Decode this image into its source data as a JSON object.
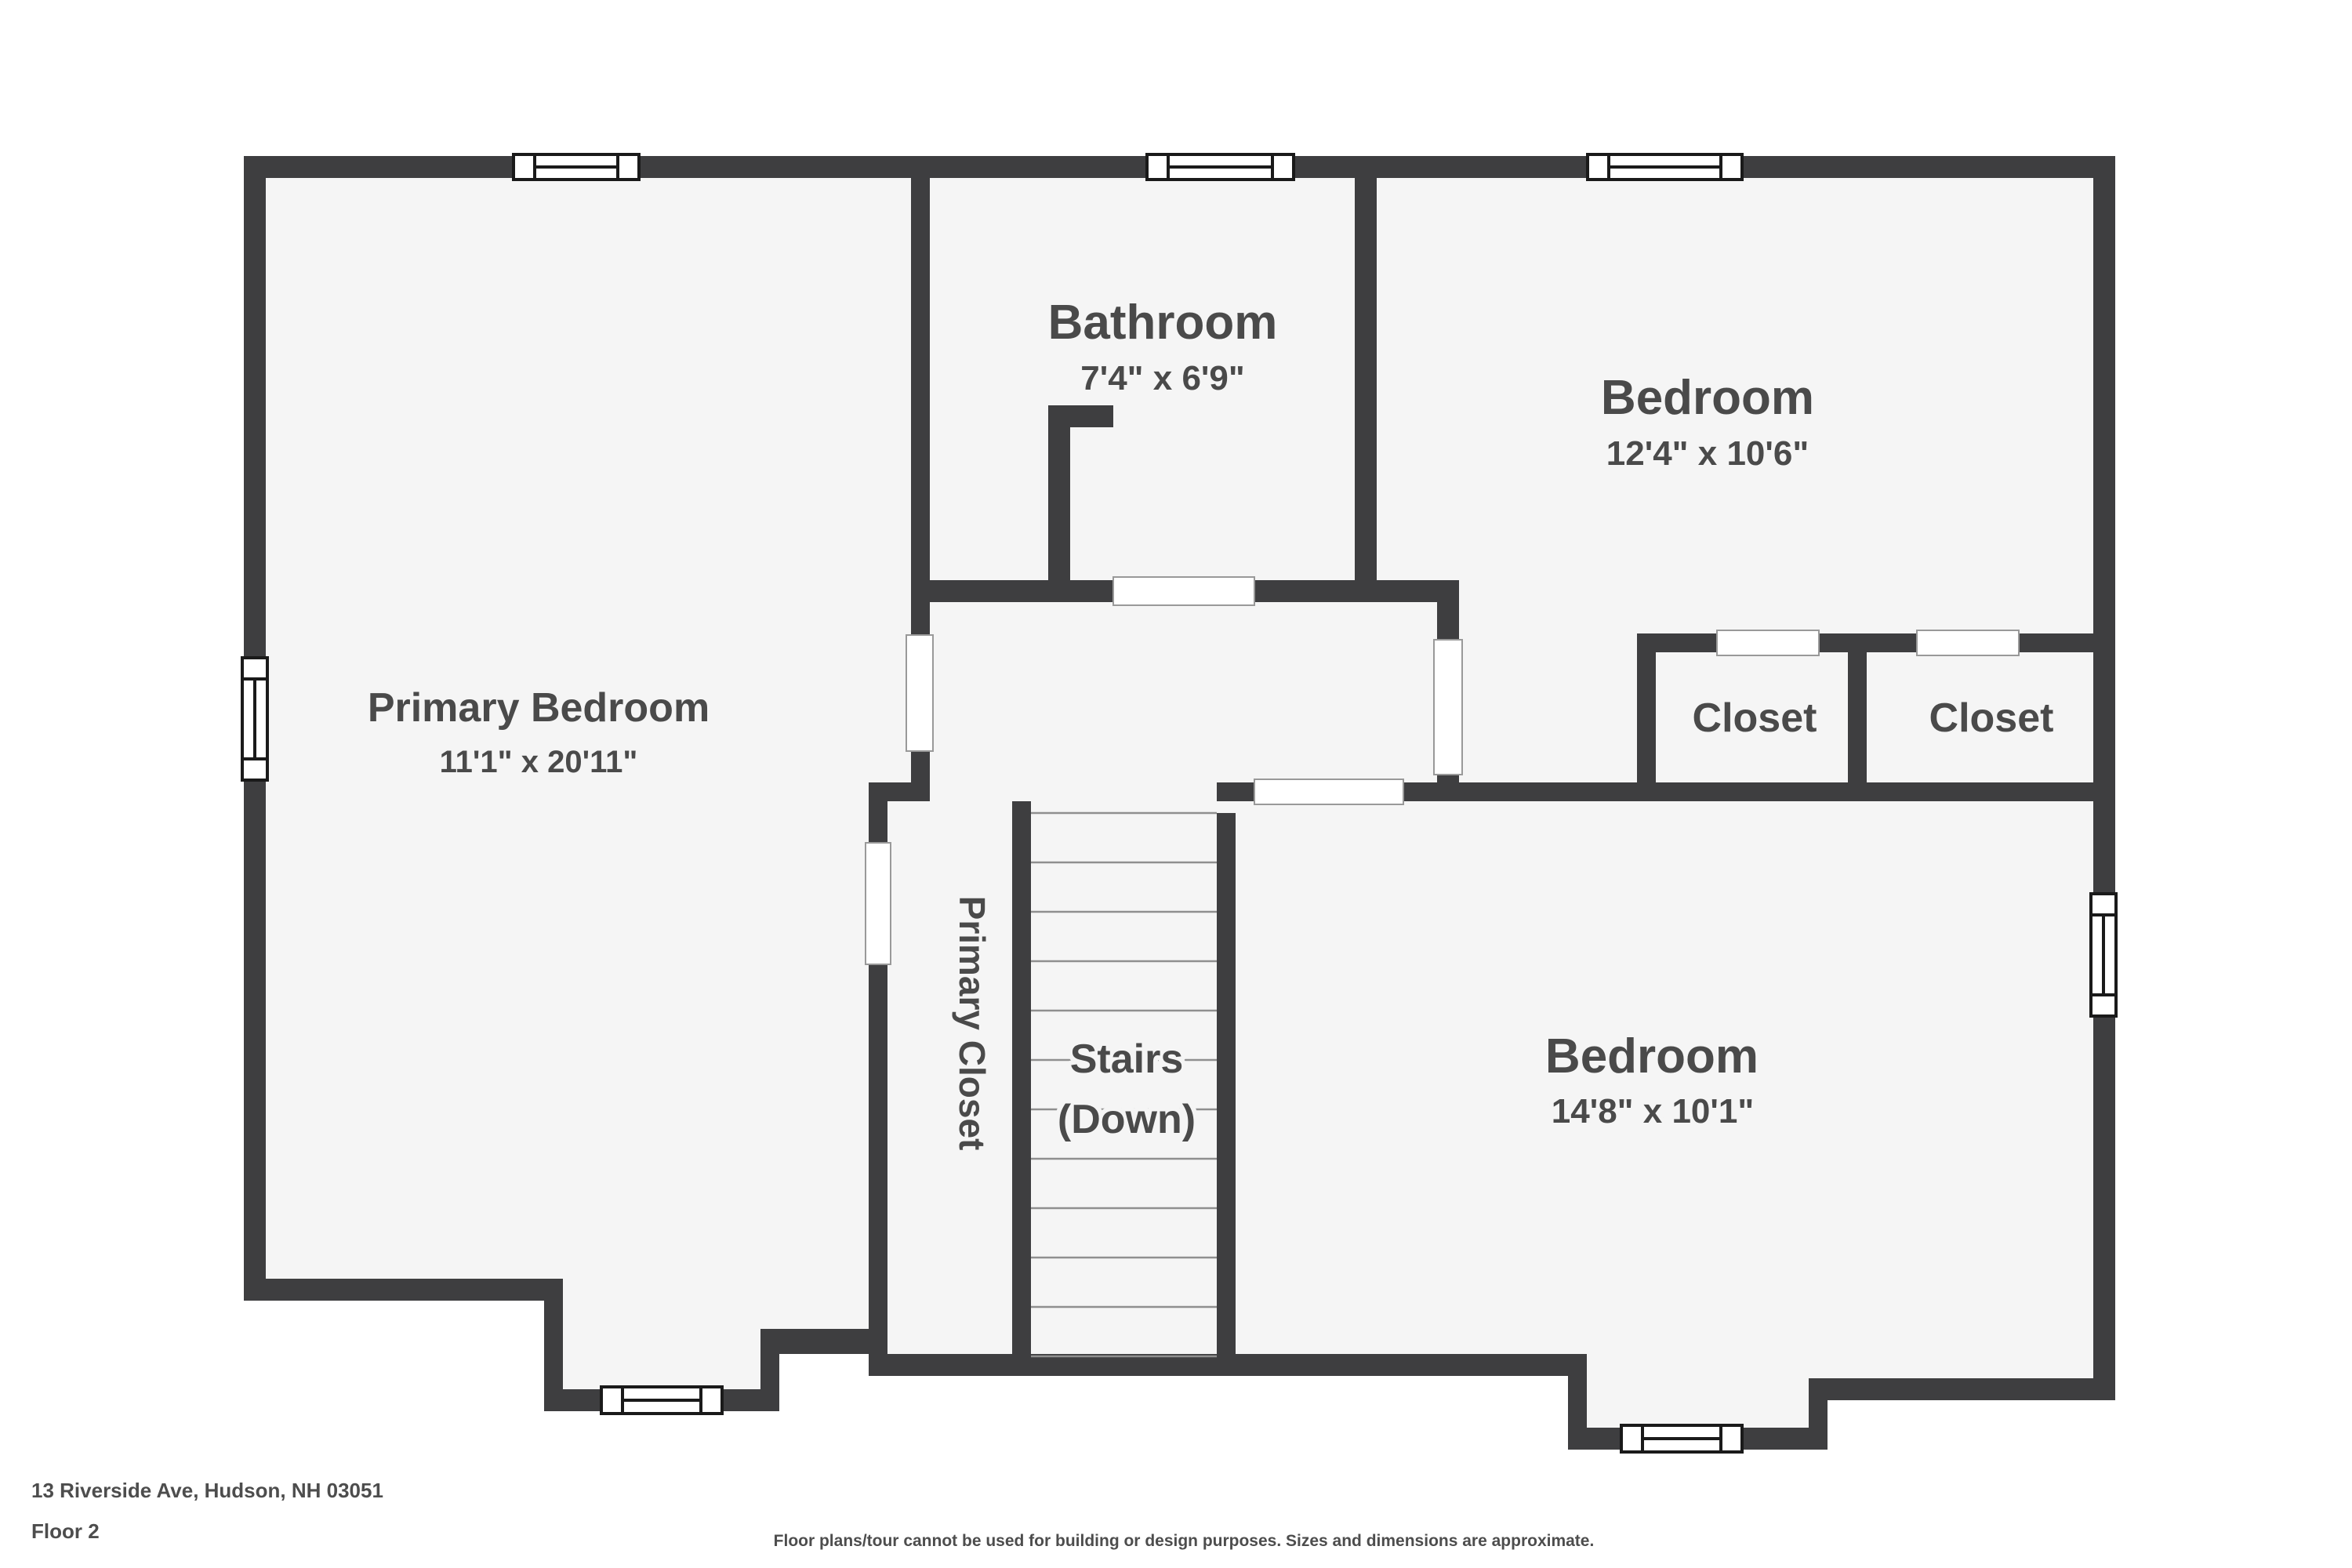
{
  "colors": {
    "wall": "#3e3e40",
    "floor": "#f5f5f5",
    "label": "#4a4a4a",
    "page_background": "#ffffff",
    "tread_line": "#8f8f8f",
    "door_outline": "#999999",
    "window_border": "#1a1a1a"
  },
  "rooms": {
    "primary_bedroom": {
      "label": "Primary Bedroom",
      "dims": "11'1\" x 20'11\""
    },
    "bathroom": {
      "label": "Bathroom",
      "dims": "7'4\" x 6'9\""
    },
    "bedroom_top": {
      "label": "Bedroom",
      "dims": "12'4\" x 10'6\""
    },
    "bedroom_bottom": {
      "label": "Bedroom",
      "dims": "14'8\" x 10'1\""
    },
    "closet_left": {
      "label": "Closet"
    },
    "closet_right": {
      "label": "Closet"
    },
    "primary_closet": {
      "label": "Primary Closet"
    },
    "stairs": {
      "label_line1": "Stairs",
      "label_line2": "(Down)"
    }
  },
  "footer": {
    "address": "13 Riverside Ave, Hudson, NH 03051",
    "floor_label": "Floor 2",
    "disclaimer": "Floor plans/tour cannot be used for building or design purposes. Sizes and dimensions are approximate."
  }
}
